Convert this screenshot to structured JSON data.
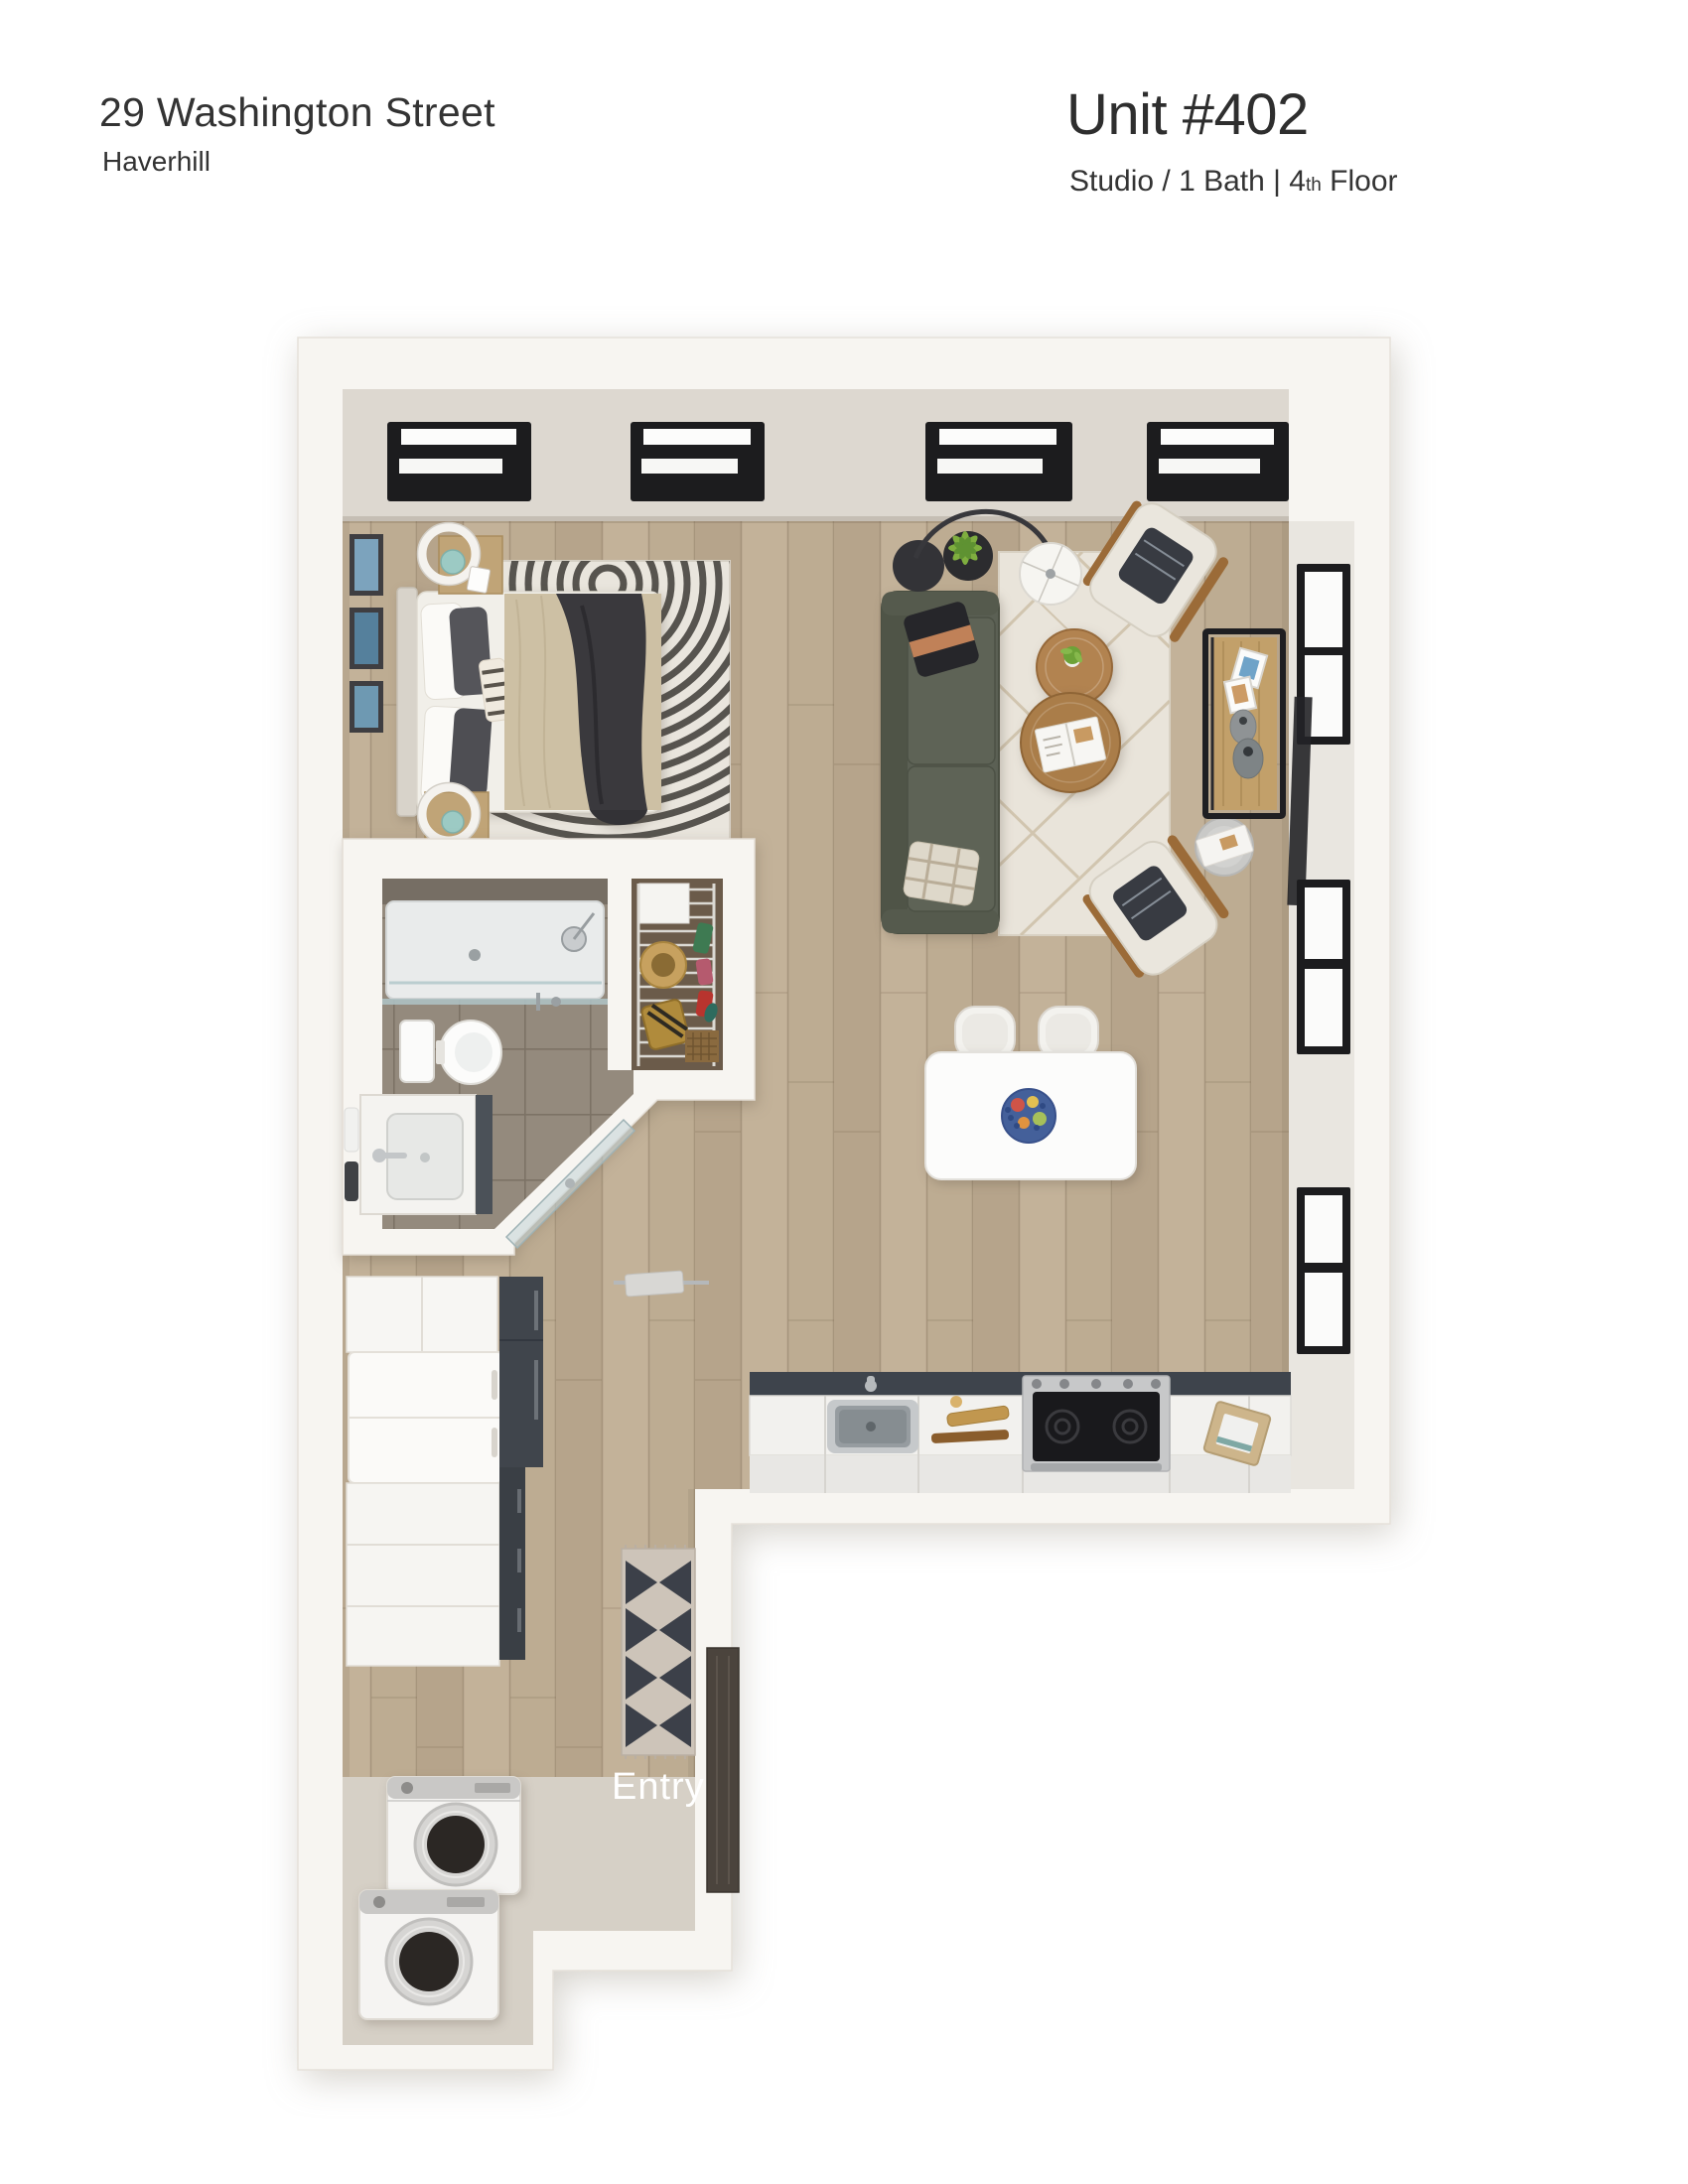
{
  "header": {
    "address": "29 Washington Street",
    "city": "Haverhill",
    "unit_title": "Unit #402",
    "spec_prefix": "Studio / 1 Bath | 4",
    "spec_ordinal": "th",
    "spec_suffix": " Floor"
  },
  "plan": {
    "entry_label": "Entry",
    "rooms": [
      "sleeping area",
      "living area",
      "bathroom",
      "closet",
      "kitchen",
      "laundry",
      "entry"
    ]
  },
  "colors": {
    "wall": "#f7f5f1",
    "ceiling": "#ddd8d0",
    "floor_wood": "#bcab92",
    "floor_entry": "#d6d0c6",
    "floor_tile": "#948a7d",
    "frame_dark": "#1c1c1e",
    "sofa_olive": "#5b6054",
    "rug_cream": "#e9e4da",
    "wood_accent": "#b28350",
    "counter_slate": "#3e444c",
    "lamp_teal": "#9ccac4",
    "door_dark": "#4b443d",
    "text_dark": "#333333",
    "label_light": "#ffffff"
  }
}
